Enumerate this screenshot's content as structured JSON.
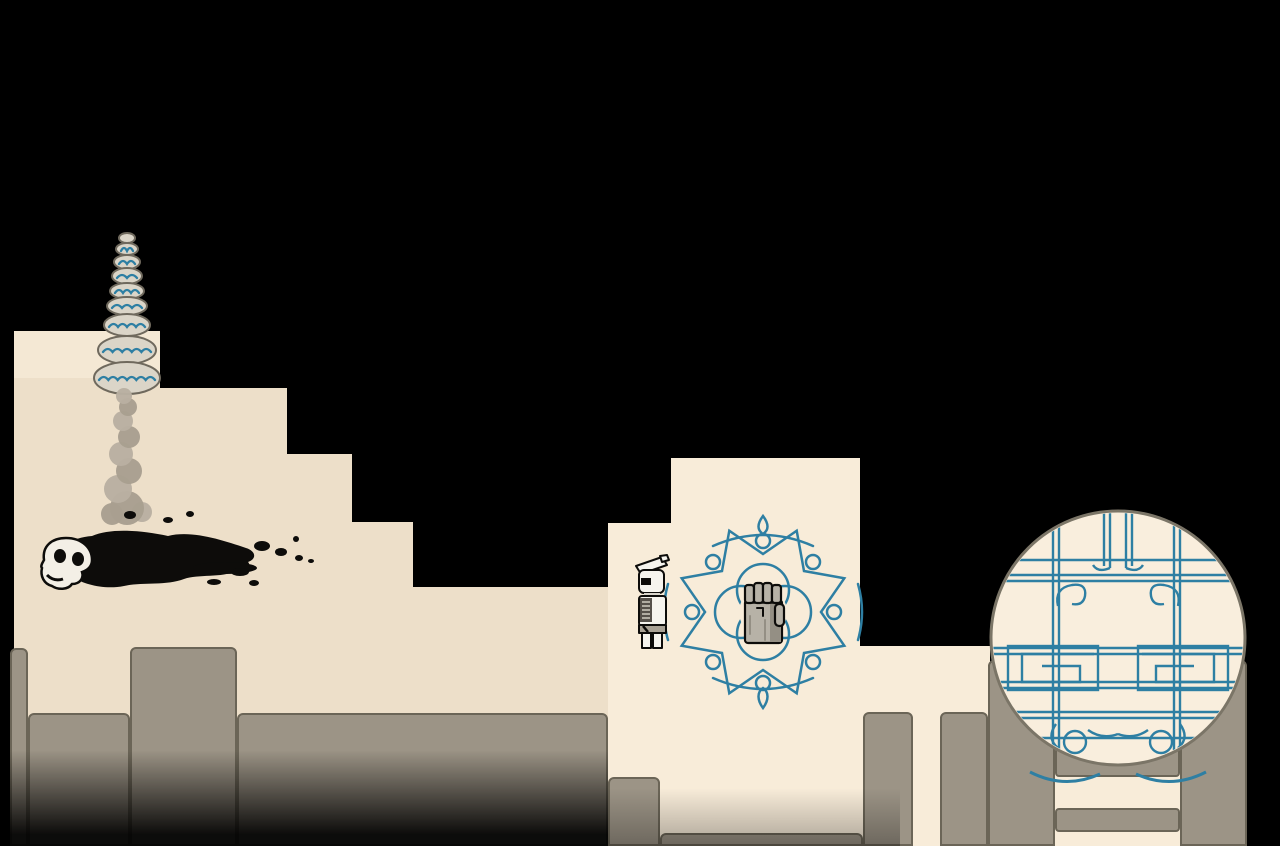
{
  "scene": {
    "description": "side-scrolling pixel-art game scene",
    "elements": [
      "cairn-totem",
      "smoke-plume",
      "charred-remains-with-skull",
      "player-robot",
      "fist-emblem-mural",
      "moon-gate",
      "stone-pillars",
      "ladder"
    ]
  },
  "colors": {
    "sky": "#000000",
    "terrace_left": "#eddfc9",
    "terrace_left_top": "#f4e8d4",
    "terrace_light": "#f8ecd9",
    "circle_face": "#f9eedd",
    "gray": "#9c9486",
    "gray_edge": "#6b6557",
    "teal": "#2e7fa3",
    "stone": "#dbd5c8",
    "stone_edge": "#6f695d",
    "smoke_a": "#a89f90",
    "smoke_b": "#b9b0a1",
    "bone": "#f3efe6",
    "ink": "#0d0c0a",
    "fist_light": "#b7b2a7",
    "fist_mid": "#948f84",
    "panel_dark": "#55504a",
    "robot_white": "#f6f4ee"
  },
  "terrain": {
    "left_polygon": "14,331 160,331 160,388 287,388 287,454 352,454 352,522 413,522 413,587 608,587 608,846 14,846",
    "left_topband": {
      "x": 14,
      "y": 331,
      "w": 146,
      "h": 47
    },
    "central_polygon": "608,523 671,523 671,458 860,458 860,846 608,846",
    "ledge": {
      "x": 860,
      "y": 646,
      "w": 130,
      "h": 200
    },
    "ladder_bg": {
      "x": 1055,
      "y": 726,
      "w": 125,
      "h": 120
    },
    "gray_blocks": [
      {
        "x": 10,
        "y": 648,
        "w": 18,
        "h": 198,
        "kind": "pillar",
        "name": "pillar-far-left"
      },
      {
        "x": 130,
        "y": 647,
        "w": 107,
        "h": 199,
        "kind": "pillar",
        "name": "pillar-left-tall"
      },
      {
        "x": 28,
        "y": 713,
        "w": 102,
        "h": 133,
        "kind": "slab",
        "name": "wall-left-a"
      },
      {
        "x": 237,
        "y": 713,
        "w": 371,
        "h": 133,
        "kind": "slab",
        "name": "wall-left-b"
      },
      {
        "x": 608,
        "y": 777,
        "w": 52,
        "h": 69,
        "kind": "slab",
        "name": "wall-center-step"
      },
      {
        "x": 660,
        "y": 833,
        "w": 203,
        "h": 13,
        "kind": "slab",
        "name": "pedestal-under-mural"
      },
      {
        "x": 863,
        "y": 712,
        "w": 50,
        "h": 134,
        "kind": "pillar",
        "name": "pillar-mid"
      },
      {
        "x": 940,
        "y": 712,
        "w": 48,
        "h": 134,
        "kind": "pillar",
        "name": "pillar-gate-left-outer"
      },
      {
        "x": 988,
        "y": 660,
        "w": 67,
        "h": 186,
        "kind": "pillar",
        "name": "gate-column-left"
      },
      {
        "x": 1180,
        "y": 660,
        "w": 67,
        "h": 186,
        "kind": "pillar",
        "name": "gate-column-right"
      },
      {
        "x": 1055,
        "y": 747,
        "w": 125,
        "h": 30,
        "kind": "rung",
        "name": "ladder-rung-1"
      },
      {
        "x": 1055,
        "y": 808,
        "w": 125,
        "h": 24,
        "kind": "rung",
        "name": "ladder-rung-2"
      }
    ]
  },
  "cairn": {
    "stones": [
      [
        127,
        238,
        8,
        5
      ],
      [
        127,
        249,
        11,
        6
      ],
      [
        127,
        262,
        13,
        7
      ],
      [
        127,
        276,
        15,
        8
      ],
      [
        127,
        291,
        17,
        8
      ],
      [
        127,
        306,
        20,
        9
      ],
      [
        127,
        325,
        23,
        11
      ],
      [
        127,
        350,
        29,
        14
      ],
      [
        127,
        378,
        33,
        16
      ]
    ]
  },
  "smoke": {
    "puffs": [
      [
        112,
        514,
        11
      ],
      [
        142,
        512,
        10
      ],
      [
        127,
        508,
        17
      ],
      [
        118,
        489,
        14
      ],
      [
        129,
        471,
        13
      ],
      [
        121,
        454,
        12
      ],
      [
        129,
        437,
        11
      ],
      [
        123,
        421,
        10
      ],
      [
        128,
        407,
        9
      ],
      [
        124,
        396,
        8
      ]
    ]
  },
  "remains": {
    "splatter": [
      [
        262,
        546,
        8,
        5
      ],
      [
        281,
        552,
        6,
        4
      ],
      [
        299,
        558,
        4,
        3
      ],
      [
        240,
        572,
        9,
        4
      ],
      [
        214,
        582,
        7,
        3
      ],
      [
        168,
        520,
        5,
        3
      ],
      [
        190,
        514,
        4,
        3
      ],
      [
        296,
        539,
        3,
        3
      ],
      [
        311,
        561,
        3,
        2
      ],
      [
        254,
        583,
        5,
        3
      ],
      [
        130,
        515,
        6,
        4
      ]
    ]
  },
  "entities": {
    "player": {
      "x": 634,
      "y": 556
    },
    "emblem": {
      "cx": 763,
      "cy": 612
    },
    "gate": {
      "cx": 1118,
      "cy": 638,
      "r": 127
    }
  }
}
